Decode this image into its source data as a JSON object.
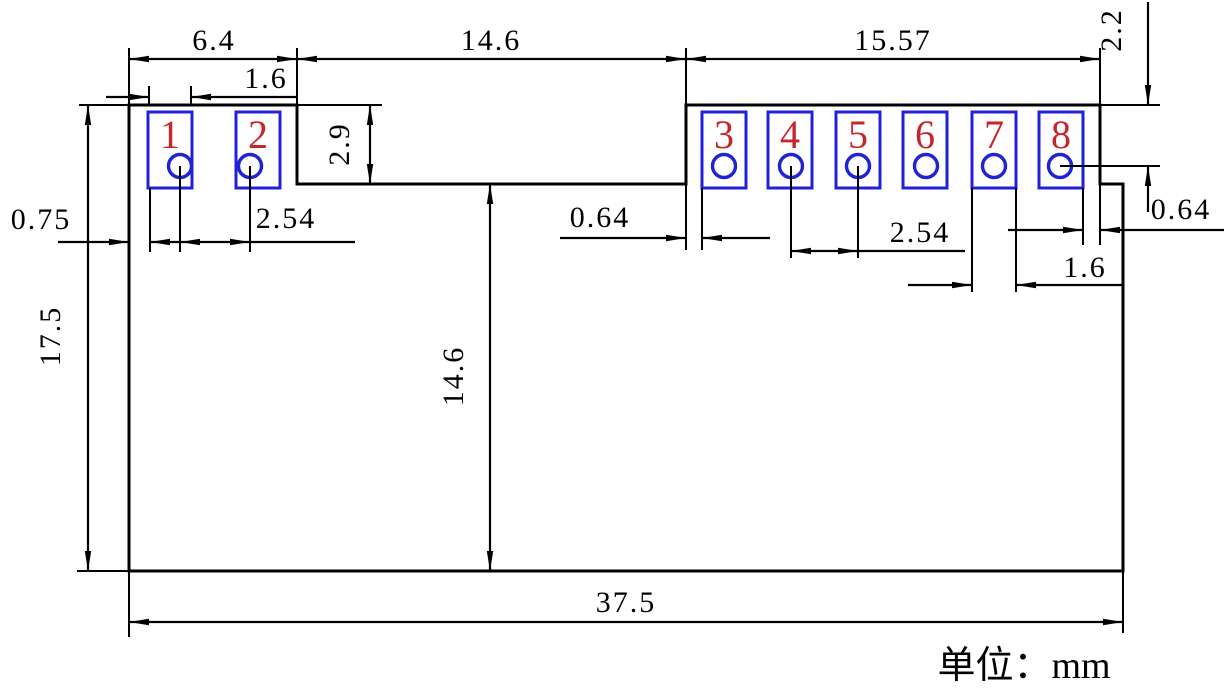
{
  "drawing": {
    "unit_note": "单位：mm",
    "pads": [
      {
        "number": "1"
      },
      {
        "number": "2"
      },
      {
        "number": "3"
      },
      {
        "number": "4"
      },
      {
        "number": "5"
      },
      {
        "number": "6"
      },
      {
        "number": "7"
      },
      {
        "number": "8"
      }
    ],
    "dims": {
      "left_section_width": "6.4",
      "pad1_width": "1.6",
      "notch_width": "14.6",
      "right_section_width": "15.57",
      "top_edge_to_hole8": "2.2",
      "notch_depth": "2.9",
      "left_edge_to_pad1": "0.75",
      "hole_pitch_left": "2.54",
      "notch_to_pad3": "0.64",
      "hole_pitch_right": "2.54",
      "pad8_to_step": "0.64",
      "pad7_width": "1.6",
      "body_height": "17.5",
      "notch_to_bottom": "14.6",
      "body_width": "37.5"
    },
    "colors": {
      "line": "#000000",
      "pad": "#2121d8",
      "pad-number": "#c5262c"
    }
  }
}
